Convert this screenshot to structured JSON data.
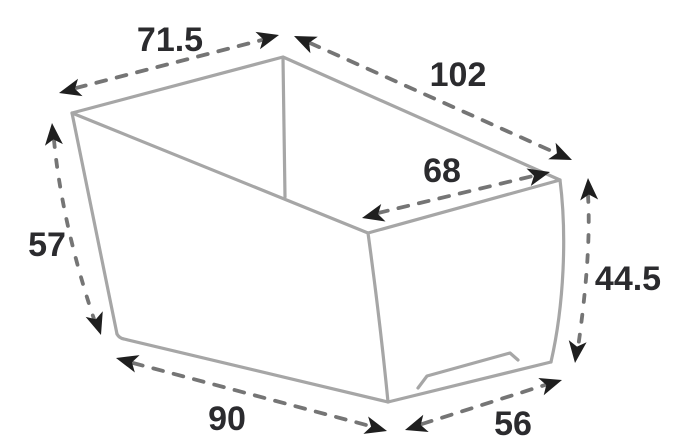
{
  "diagram": {
    "type": "dimensioned-product-sketch",
    "subject": "tapered rectangular box / planter, perspective pencil sketch with dashed dimension arrows",
    "labels": {
      "top_edge_left": "71.5",
      "top_edge_right": "102",
      "rim_inner": "68",
      "height_left": "57",
      "height_right": "44.5",
      "bottom_edge_left": "90",
      "bottom_edge_right": "56"
    },
    "colors": {
      "background": "#ffffff",
      "sketch_line": "#a6a6a6",
      "dimension_dash": "#757575",
      "arrowhead": "#1f1f1f",
      "label_text": "#2b2b2e"
    }
  }
}
